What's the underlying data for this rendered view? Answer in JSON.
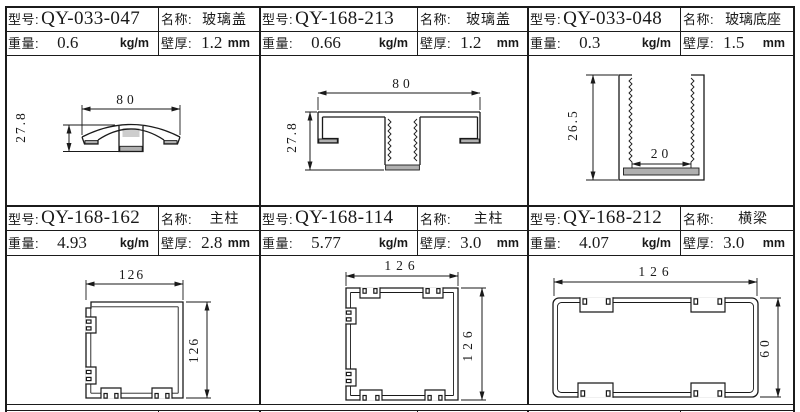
{
  "table": {
    "labels": {
      "model": "型号:",
      "name": "名称:",
      "weight": "重量:",
      "thickness": "壁厚:",
      "weight_unit": "kg/m",
      "thickness_unit": "mm"
    },
    "cells": [
      {
        "model": "QY-033-047",
        "name": "玻璃盖",
        "weight": "0.6",
        "thickness": "1.2",
        "dims": {
          "w": "80",
          "h": "27.8"
        }
      },
      {
        "model": "QY-168-213",
        "name": "玻璃盖",
        "weight": "0.66",
        "thickness": "1.2",
        "dims": {
          "w": "80",
          "h": "27.8"
        }
      },
      {
        "model": "QY-033-048",
        "name": "玻璃底座",
        "weight": "0.3",
        "thickness": "1.5",
        "dims": {
          "w": "20",
          "h": "26.5"
        }
      },
      {
        "model": "QY-168-162",
        "name": "主柱",
        "weight": "4.93",
        "thickness": "2.8",
        "dims": {
          "w": "126",
          "h": "126"
        }
      },
      {
        "model": "QY-168-114",
        "name": "主柱",
        "weight": "5.77",
        "thickness": "3.0",
        "dims": {
          "w": "126",
          "h": "126"
        }
      },
      {
        "model": "QY-168-212",
        "name": "横梁",
        "weight": "4.07",
        "thickness": "3.0",
        "dims": {
          "w": "126",
          "h": "60"
        }
      }
    ]
  },
  "colors": {
    "line": "#1a1a1a",
    "background": "#ffffff",
    "section_fill": "#b0b0b0"
  }
}
